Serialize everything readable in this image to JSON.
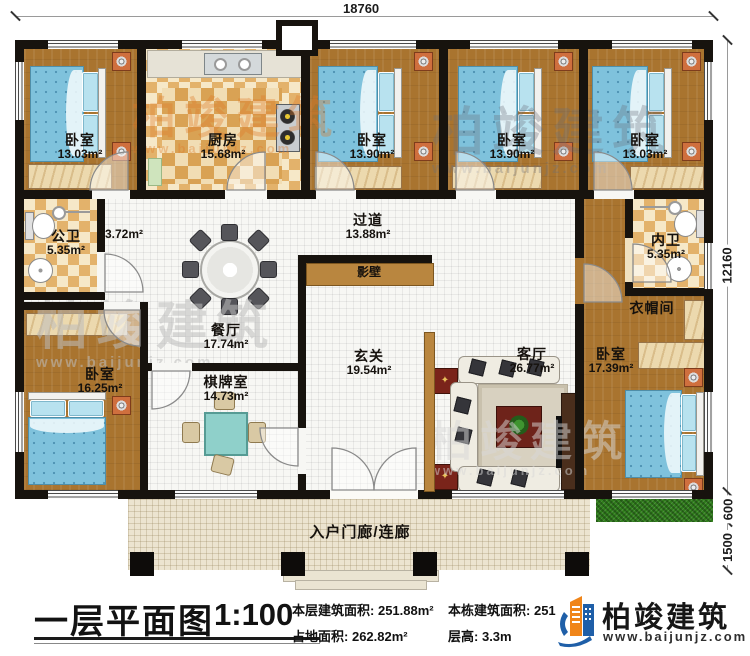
{
  "plan": {
    "dimensions": {
      "width_top": "18760",
      "height_right": "12160",
      "grass_depth": "600",
      "porch_depth": "1500"
    },
    "rooms": {
      "bedroom_tl": {
        "name": "卧室",
        "area": "13.03m²"
      },
      "kitchen": {
        "name": "厨房",
        "area": "15.68m²"
      },
      "bedroom_tm": {
        "name": "卧室",
        "area": "13.90m²"
      },
      "bedroom_tm2": {
        "name": "卧室",
        "area": "13.90m²"
      },
      "bedroom_tr": {
        "name": "卧室",
        "area": "13.03m²"
      },
      "public_bath": {
        "name": "公卫",
        "area": "5.35m²"
      },
      "hallway": {
        "area": "3.72m²"
      },
      "corridor": {
        "name": "过道",
        "area": "13.88m²"
      },
      "screen_wall": {
        "name": "影壁"
      },
      "inner_bath": {
        "name": "内卫",
        "area": "5.35m²"
      },
      "cloakroom": {
        "name": "衣帽间"
      },
      "dining": {
        "name": "餐厅",
        "area": "17.74m²"
      },
      "bedroom_bl": {
        "name": "卧室",
        "area": "16.25m²"
      },
      "chess_room": {
        "name": "棋牌室",
        "area": "14.73m²"
      },
      "foyer": {
        "name": "玄关",
        "area": "19.54m²"
      },
      "living": {
        "name": "客厅",
        "area": "26.77m²"
      },
      "bedroom_br": {
        "name": "卧室",
        "area": "17.39m²"
      },
      "porch": {
        "name": "入户门廊/连廊"
      }
    }
  },
  "info_bar": {
    "title": "一层平面图",
    "scale": "1:100",
    "stats": [
      {
        "label": "本层建筑面积:",
        "value": "251.88m²"
      },
      {
        "label": "占地面积:",
        "value": "262.82m²"
      },
      {
        "label": "本栋建筑面积:",
        "value": "251.88m²"
      },
      {
        "label": "层高:",
        "value": "3.3m"
      }
    ]
  },
  "branding": {
    "logo_text": "柏竣建筑",
    "website": "www.baijunjz.com"
  },
  "watermark": {
    "text": "柏竣建筑",
    "url": "www.baijunjz.com"
  },
  "decor": {
    "table_star": "✦"
  },
  "icons": {
    "logo": "building-logo-icon"
  },
  "colors": {
    "wall": "#17130e",
    "wood": "#a9742f",
    "tile_check": "#e3b26b",
    "brand_blue": "#1f5fa8",
    "brand_orange": "#f08519",
    "grass": "#2f7d1b",
    "bed": "#7fc2dc"
  }
}
